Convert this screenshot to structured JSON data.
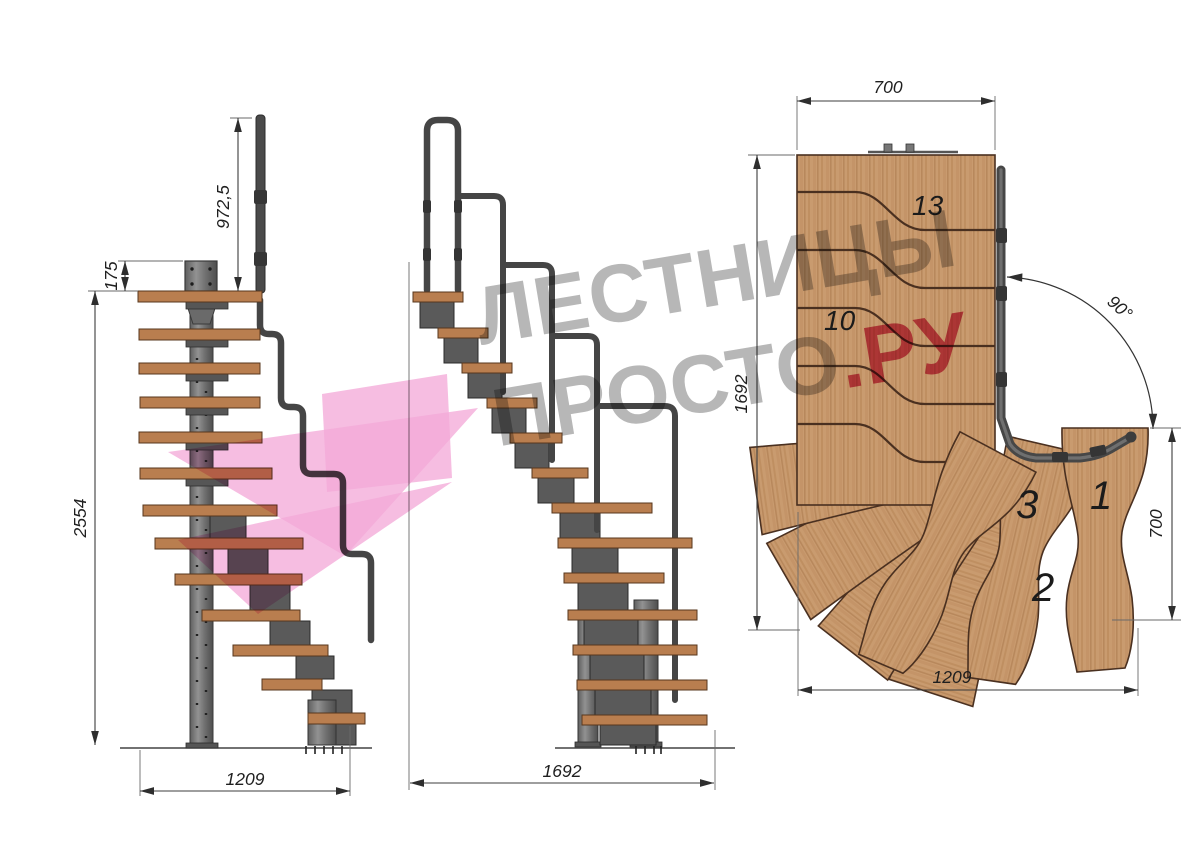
{
  "watermark": {
    "line1": "ЛЕСТНИЦЫ",
    "line2_main": "ПРОСТО",
    "line2_accent": ".РУ",
    "text_color": "#b1b1b1",
    "accent_color": "#d7496d",
    "logo_color": "#f3abd9"
  },
  "side_view": {
    "name": "side-elevation",
    "dims": {
      "handrail_height": "972,5",
      "top_step_offset": "175",
      "total_height": "2554",
      "flight_length": "1209"
    }
  },
  "front_view": {
    "name": "front-elevation",
    "dims": {
      "flight_length": "1692"
    }
  },
  "plan_view": {
    "name": "plan-view",
    "dims": {
      "upper_flight_width": "700",
      "upper_flight_length": "1692",
      "turn_angle": "90°",
      "lower_flight_width": "700",
      "lower_flight_length": "1209"
    },
    "step_labels": [
      "13",
      "10",
      "3",
      "1",
      "2"
    ]
  },
  "colors": {
    "wood_light": "#c99b6f",
    "wood_dark": "#a97c50",
    "metal": "#737373",
    "metal_dark": "#3f3f3f",
    "line": "#2a2a2a"
  }
}
